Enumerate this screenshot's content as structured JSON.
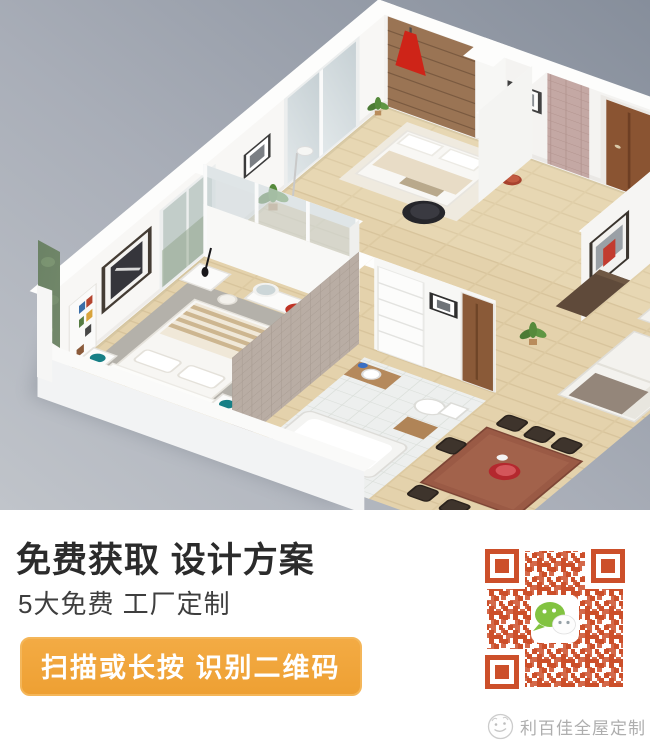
{
  "hero": {
    "alt": "3D isometric cutaway render of a furnished apartment floor plan",
    "colors": {
      "background_top": "#868e9b",
      "background_bottom": "#c0c4ca",
      "walls": "#f7f6f4",
      "wood_floor": "#e4d2ac",
      "accent_red": "#ce2418",
      "tile_gray": "#b9ada4",
      "tile_mauve": "#c4a8a4"
    },
    "rooms": [
      "entry-hall",
      "bedroom",
      "master-bedroom",
      "bathroom",
      "corridor",
      "living-room",
      "dining-area"
    ]
  },
  "promo": {
    "headline": "免费获取 设计方案",
    "subheadline": "5大免费 工厂定制",
    "cta_label": "扫描或长按 识别二维码",
    "cta_background": "#f0a43c",
    "cta_text_color": "#ffffff"
  },
  "qr": {
    "module_color": "#cc4f2a",
    "center_icon": "wechat-logo",
    "wechat_green": "#82c341"
  },
  "brand": {
    "name": "利百佳全屋定制",
    "text_color": "#aeaeae"
  }
}
